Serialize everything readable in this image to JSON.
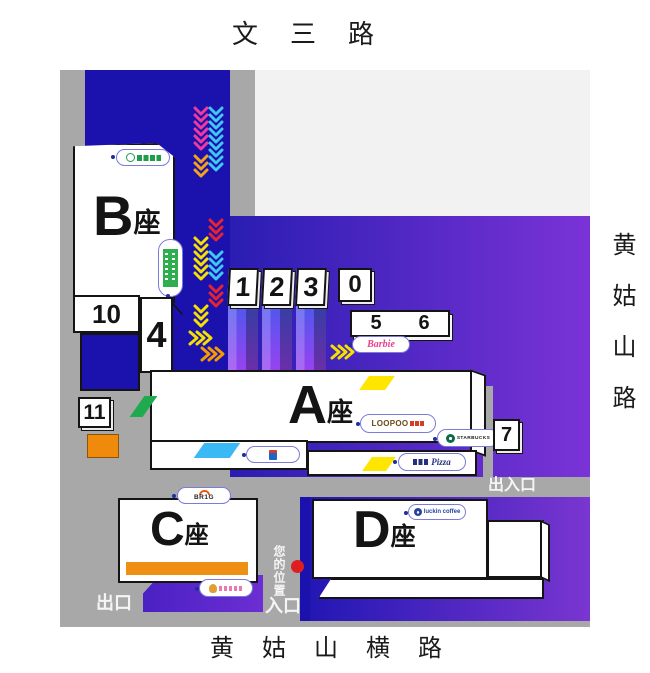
{
  "streets": {
    "top": "文三路",
    "right": "黄姑山路",
    "bottom": "黄姑山横路"
  },
  "buildings": {
    "a": {
      "letter": "A",
      "suffix": "座"
    },
    "b": {
      "letter": "B",
      "suffix": "座"
    },
    "c": {
      "letter": "C",
      "suffix": "座"
    },
    "d": {
      "letter": "D",
      "suffix": "座"
    }
  },
  "gates": {
    "g1": "1",
    "g2": "2",
    "g3": "3",
    "g0": "0",
    "g4": "4",
    "g5": "5",
    "g6": "6",
    "g7": "7",
    "g10": "10",
    "g11": "11"
  },
  "markers": {
    "exit_entrance": "出入口",
    "exit": "出口",
    "entrance": "入口",
    "you_are_here": "您的位置"
  },
  "brands": {
    "barbie": "Barbie",
    "loopoo": "LOOPOO",
    "starbucks": "STARBUCKS",
    "pizza": "Pizza",
    "brig": "BR1G",
    "luckin": "luckin coffee"
  },
  "colors": {
    "road_gray": "#a8a8a8",
    "light_gray": "#f2f2f2",
    "corridor_blue": "#1b12ae",
    "purple_from": "#2a1db2",
    "purple_to": "#7a33d6",
    "orange": "#ef8a0c",
    "barbie_pink": "#e8418c",
    "starbucks_green": "#0a6c47",
    "luckin_blue": "#2743a0",
    "location_red": "#dd1f1f",
    "chevron_magenta": "#ef3a9e",
    "chevron_cyan": "#3ec8f2",
    "chevron_yellow": "#f5e000",
    "chevron_orange": "#f59a00",
    "chevron_red": "#e82330"
  },
  "decor": {
    "chevron_columns": [
      {
        "x": 135,
        "groups": [
          {
            "color": "#ef3a9e",
            "y": 38,
            "count": 6,
            "step": 7
          },
          {
            "color": "#f5a21b",
            "y": 86,
            "count": 3,
            "step": 7
          },
          {
            "color": "#f5e000",
            "y": 168,
            "count": 6,
            "step": 7
          },
          {
            "color": "#f5e000",
            "y": 236,
            "count": 3,
            "step": 7
          }
        ]
      },
      {
        "x": 150,
        "groups": [
          {
            "color": "#3ec8f2",
            "y": 38,
            "count": 9,
            "step": 7
          },
          {
            "color": "#e82330",
            "y": 150,
            "count": 3,
            "step": 7
          },
          {
            "color": "#3ec8f2",
            "y": 182,
            "count": 4,
            "step": 7
          },
          {
            "color": "#e82330",
            "y": 216,
            "count": 3,
            "step": 7
          }
        ]
      }
    ],
    "chevron_rows": [
      {
        "x": 130,
        "y": 262,
        "color": "#f5e000",
        "count": 3,
        "step": 7
      },
      {
        "x": 142,
        "y": 278,
        "color": "#f59a00",
        "count": 3,
        "step": 7
      },
      {
        "x": 272,
        "y": 276,
        "color": "#f5e000",
        "count": 3,
        "step": 7
      }
    ],
    "pointer_line": {
      "x1": 106,
      "y1": 226,
      "x2": 122,
      "y2": 244
    }
  }
}
